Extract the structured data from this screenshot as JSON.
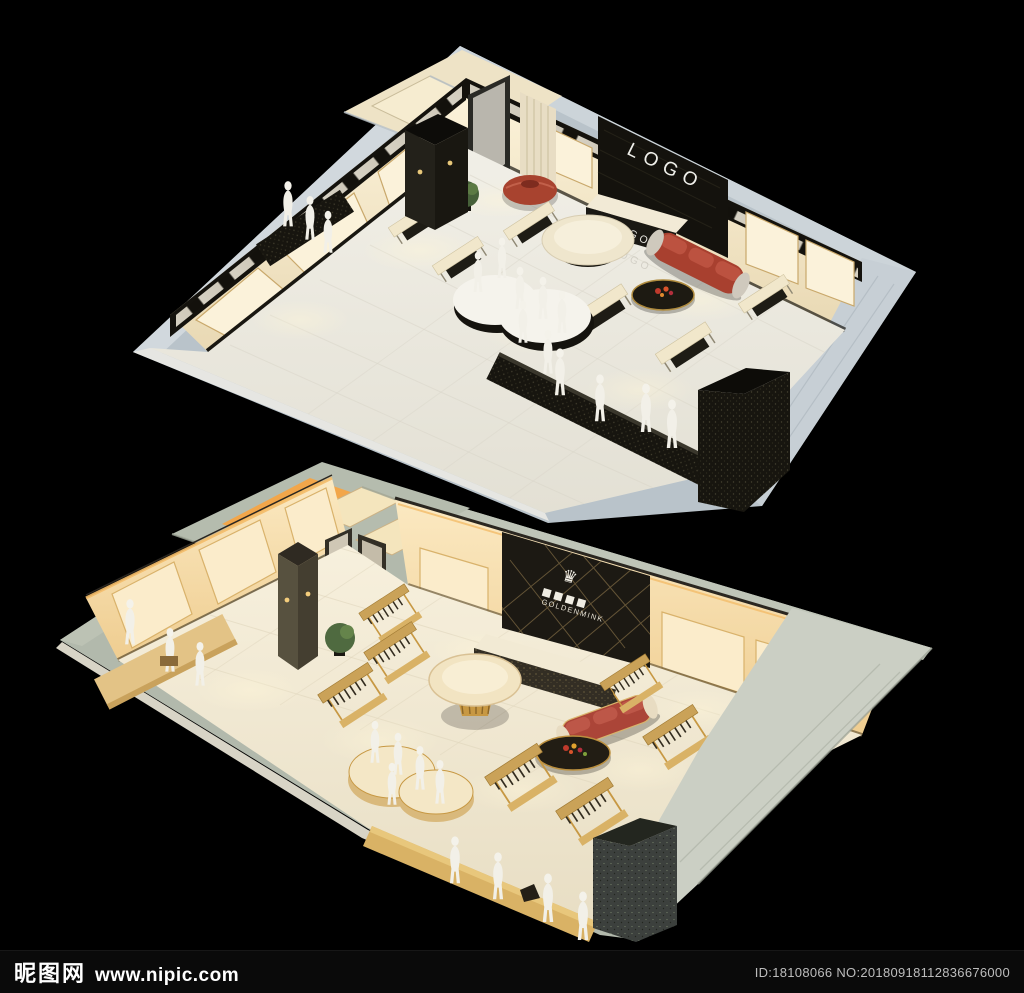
{
  "scene": {
    "background_color": "#000000",
    "top_render": {
      "label": "3D store interior rendering, cool white scheme",
      "logo_wall_text": "LOGO",
      "logo_desk_text": "LOGO",
      "sofa_color": "#a8402f",
      "shell_color": "#b9c3ca"
    },
    "bottom_render": {
      "label": "3D store interior rendering, warm golden scheme",
      "sign_crown": "♛",
      "sign_text": "GOLDENMINK",
      "sofa_color": "#ab4538",
      "shell_color": "#b2b9ac"
    }
  },
  "watermark": {
    "site_name": "昵图网",
    "site_url": "www.nipic.com",
    "id_text": "ID:18108066 NO:20180918112836676000"
  }
}
